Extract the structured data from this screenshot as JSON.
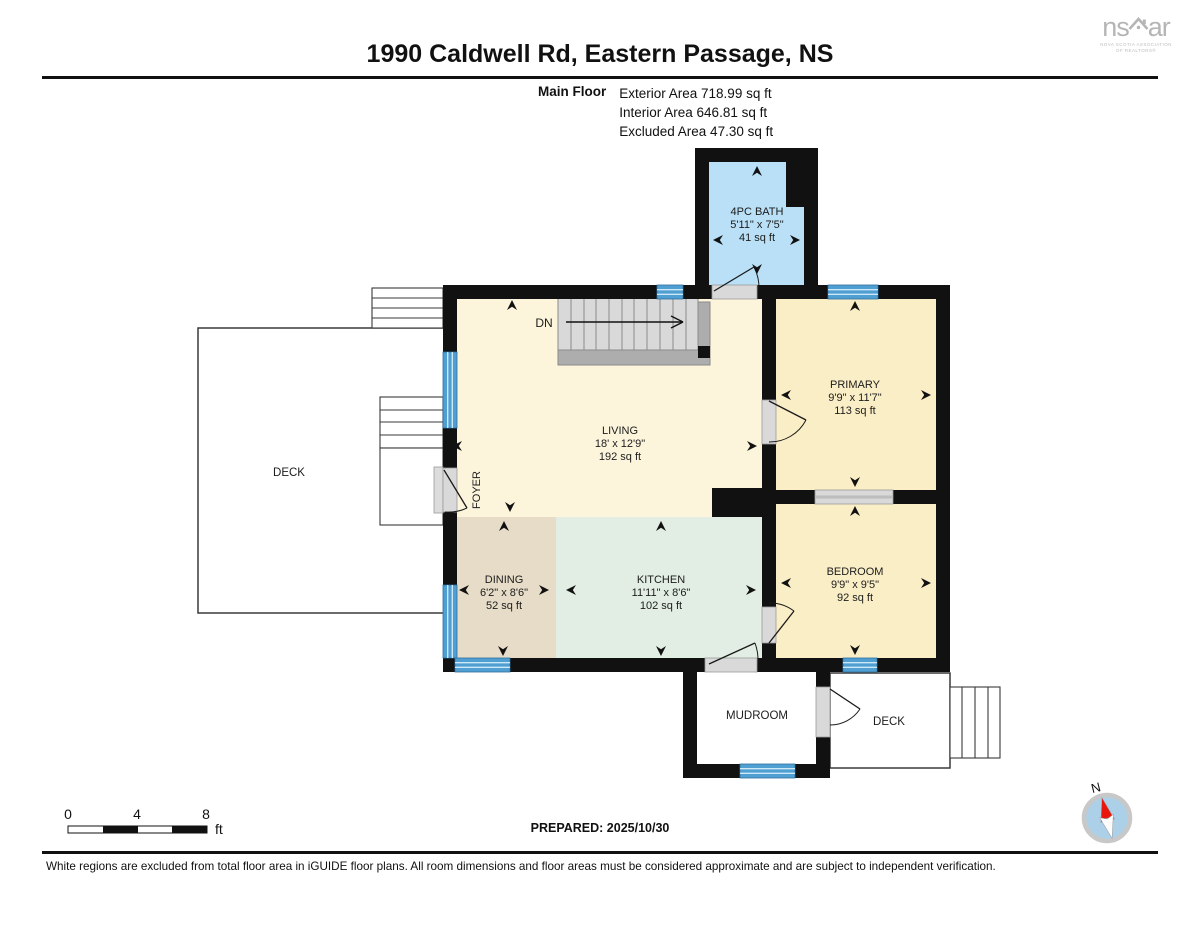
{
  "header": {
    "title": "1990 Caldwell Rd, Eastern Passage, NS"
  },
  "logo": {
    "ns": "ns",
    "ar": "ar",
    "tagline1": "NOVA SCOTIA ASSOCIATION",
    "tagline2": "OF REALTORS®"
  },
  "floor_info": {
    "label": "Main Floor",
    "exterior": "Exterior Area 718.99 sq ft",
    "interior": "Interior Area 646.81 sq ft",
    "excluded": "Excluded Area 47.30 sq ft"
  },
  "rooms": {
    "bath": {
      "name": "4PC BATH",
      "dims": "5'11\" x 7'5\"",
      "area": "41 sq ft"
    },
    "living": {
      "name": "LIVING",
      "dims": "18' x 12'9\"",
      "area": "192 sq ft"
    },
    "primary": {
      "name": "PRIMARY",
      "dims": "9'9\" x 11'7\"",
      "area": "113 sq ft"
    },
    "bedroom": {
      "name": "BEDROOM",
      "dims": "9'9\" x 9'5\"",
      "area": "92 sq ft"
    },
    "dining": {
      "name": "DINING",
      "dims": "6'2\" x 8'6\"",
      "area": "52 sq ft"
    },
    "kitchen": {
      "name": "KITCHEN",
      "dims": "11'11\" x 8'6\"",
      "area": "102 sq ft"
    },
    "mudroom": {
      "name": "MUDROOM"
    },
    "foyer": {
      "name": "FOYER"
    },
    "deck_left": {
      "name": "DECK"
    },
    "deck_right": {
      "name": "DECK"
    }
  },
  "stairs": {
    "down_label": "DN"
  },
  "scale_bar": {
    "tick0": "0",
    "tick1": "4",
    "tick2": "8",
    "unit": "ft"
  },
  "compass": {
    "north": "N"
  },
  "footer": {
    "prepared": "PREPARED: 2025/10/30",
    "disclaimer": "White regions are excluded from total floor area in iGUIDE floor plans. All room dimensions and floor areas must be considered approximate and are subject to independent verification."
  },
  "colors": {
    "bath": "#b9e0f6",
    "living": "#fcf5dc",
    "bedrooms": "#faeec6",
    "dining": "#e7dcc7",
    "kitchen": "#e2ede3",
    "window": "#4f9fd3",
    "wall": "#111111",
    "logo_gray": "#b5b5b5"
  }
}
